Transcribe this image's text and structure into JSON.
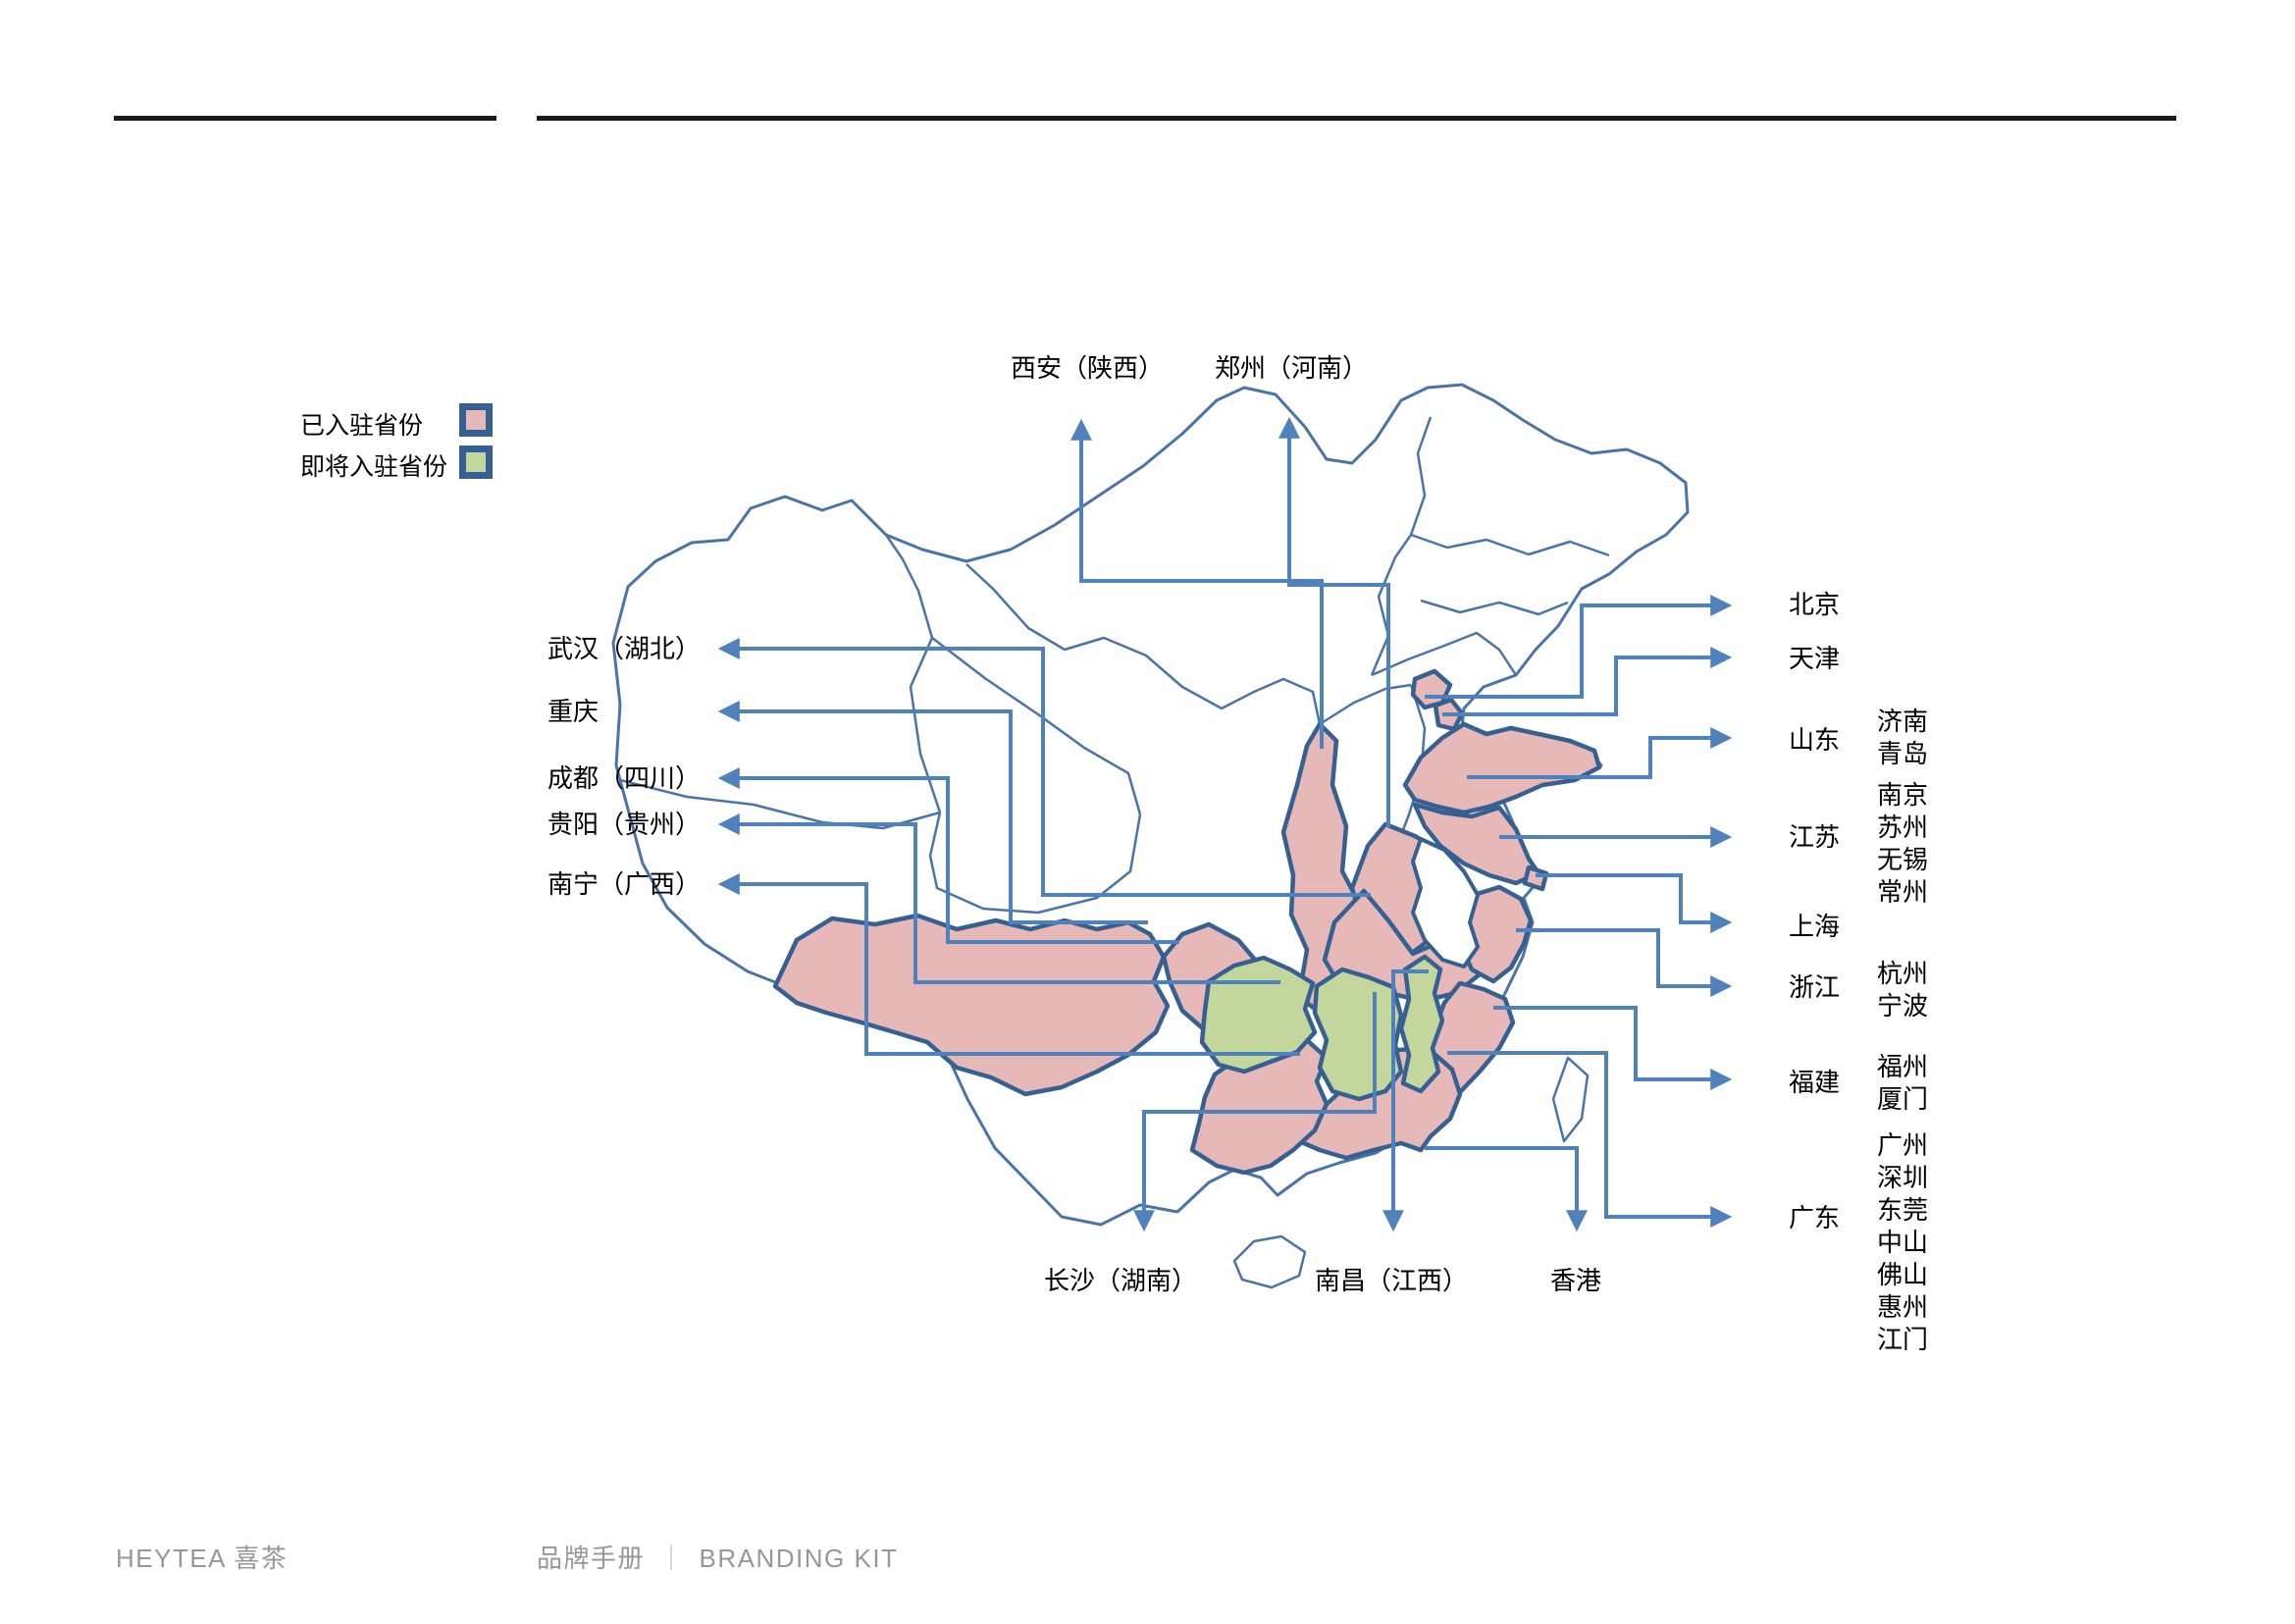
{
  "legend": {
    "items": [
      {
        "label": "已入驻省份",
        "color": "#E6B9B8"
      },
      {
        "label": "即将入驻省份",
        "color": "#C3D69B"
      }
    ]
  },
  "map": {
    "entered_provinces": [
      "陕西",
      "河南",
      "湖北",
      "重庆",
      "四川",
      "广西",
      "广东",
      "福建",
      "浙江",
      "上海",
      "江苏",
      "山东",
      "北京",
      "天津"
    ],
    "upcoming_provinces": [
      "贵州",
      "湖南",
      "江西"
    ],
    "colors": {
      "entered_fill": "#E6B9B8",
      "upcoming_fill": "#C3D69B",
      "callout_line": "#4F81BD",
      "province_border": "#376092",
      "outline": "#4a74a8"
    }
  },
  "callouts": {
    "top": [
      {
        "label": "西安（陕西）"
      },
      {
        "label": "郑州（河南）"
      }
    ],
    "left": [
      {
        "label": "武汉（湖北）"
      },
      {
        "label": "重庆"
      },
      {
        "label": "成都（四川）"
      },
      {
        "label": "贵阳（贵州）"
      },
      {
        "label": "南宁（广西）"
      }
    ],
    "bottom": [
      {
        "label": "长沙（湖南）"
      },
      {
        "label": "南昌（江西）"
      },
      {
        "label": "香港"
      }
    ],
    "right": [
      {
        "label": "北京",
        "cities": []
      },
      {
        "label": "天津",
        "cities": []
      },
      {
        "label": "山东",
        "cities": [
          "济南",
          "青岛"
        ]
      },
      {
        "label": "江苏",
        "cities": [
          "南京",
          "苏州",
          "无锡",
          "常州"
        ]
      },
      {
        "label": "上海",
        "cities": []
      },
      {
        "label": "浙江",
        "cities": [
          "杭州",
          "宁波"
        ]
      },
      {
        "label": "福建",
        "cities": [
          "福州",
          "厦门"
        ]
      },
      {
        "label": "广东",
        "cities": [
          "广州",
          "深圳",
          "东莞",
          "中山",
          "佛山",
          "惠州",
          "江门"
        ]
      }
    ]
  },
  "footer": {
    "brand": "HEYTEA 喜茶",
    "left": "品牌手册",
    "divider": "｜",
    "right": "BRANDING KIT"
  }
}
